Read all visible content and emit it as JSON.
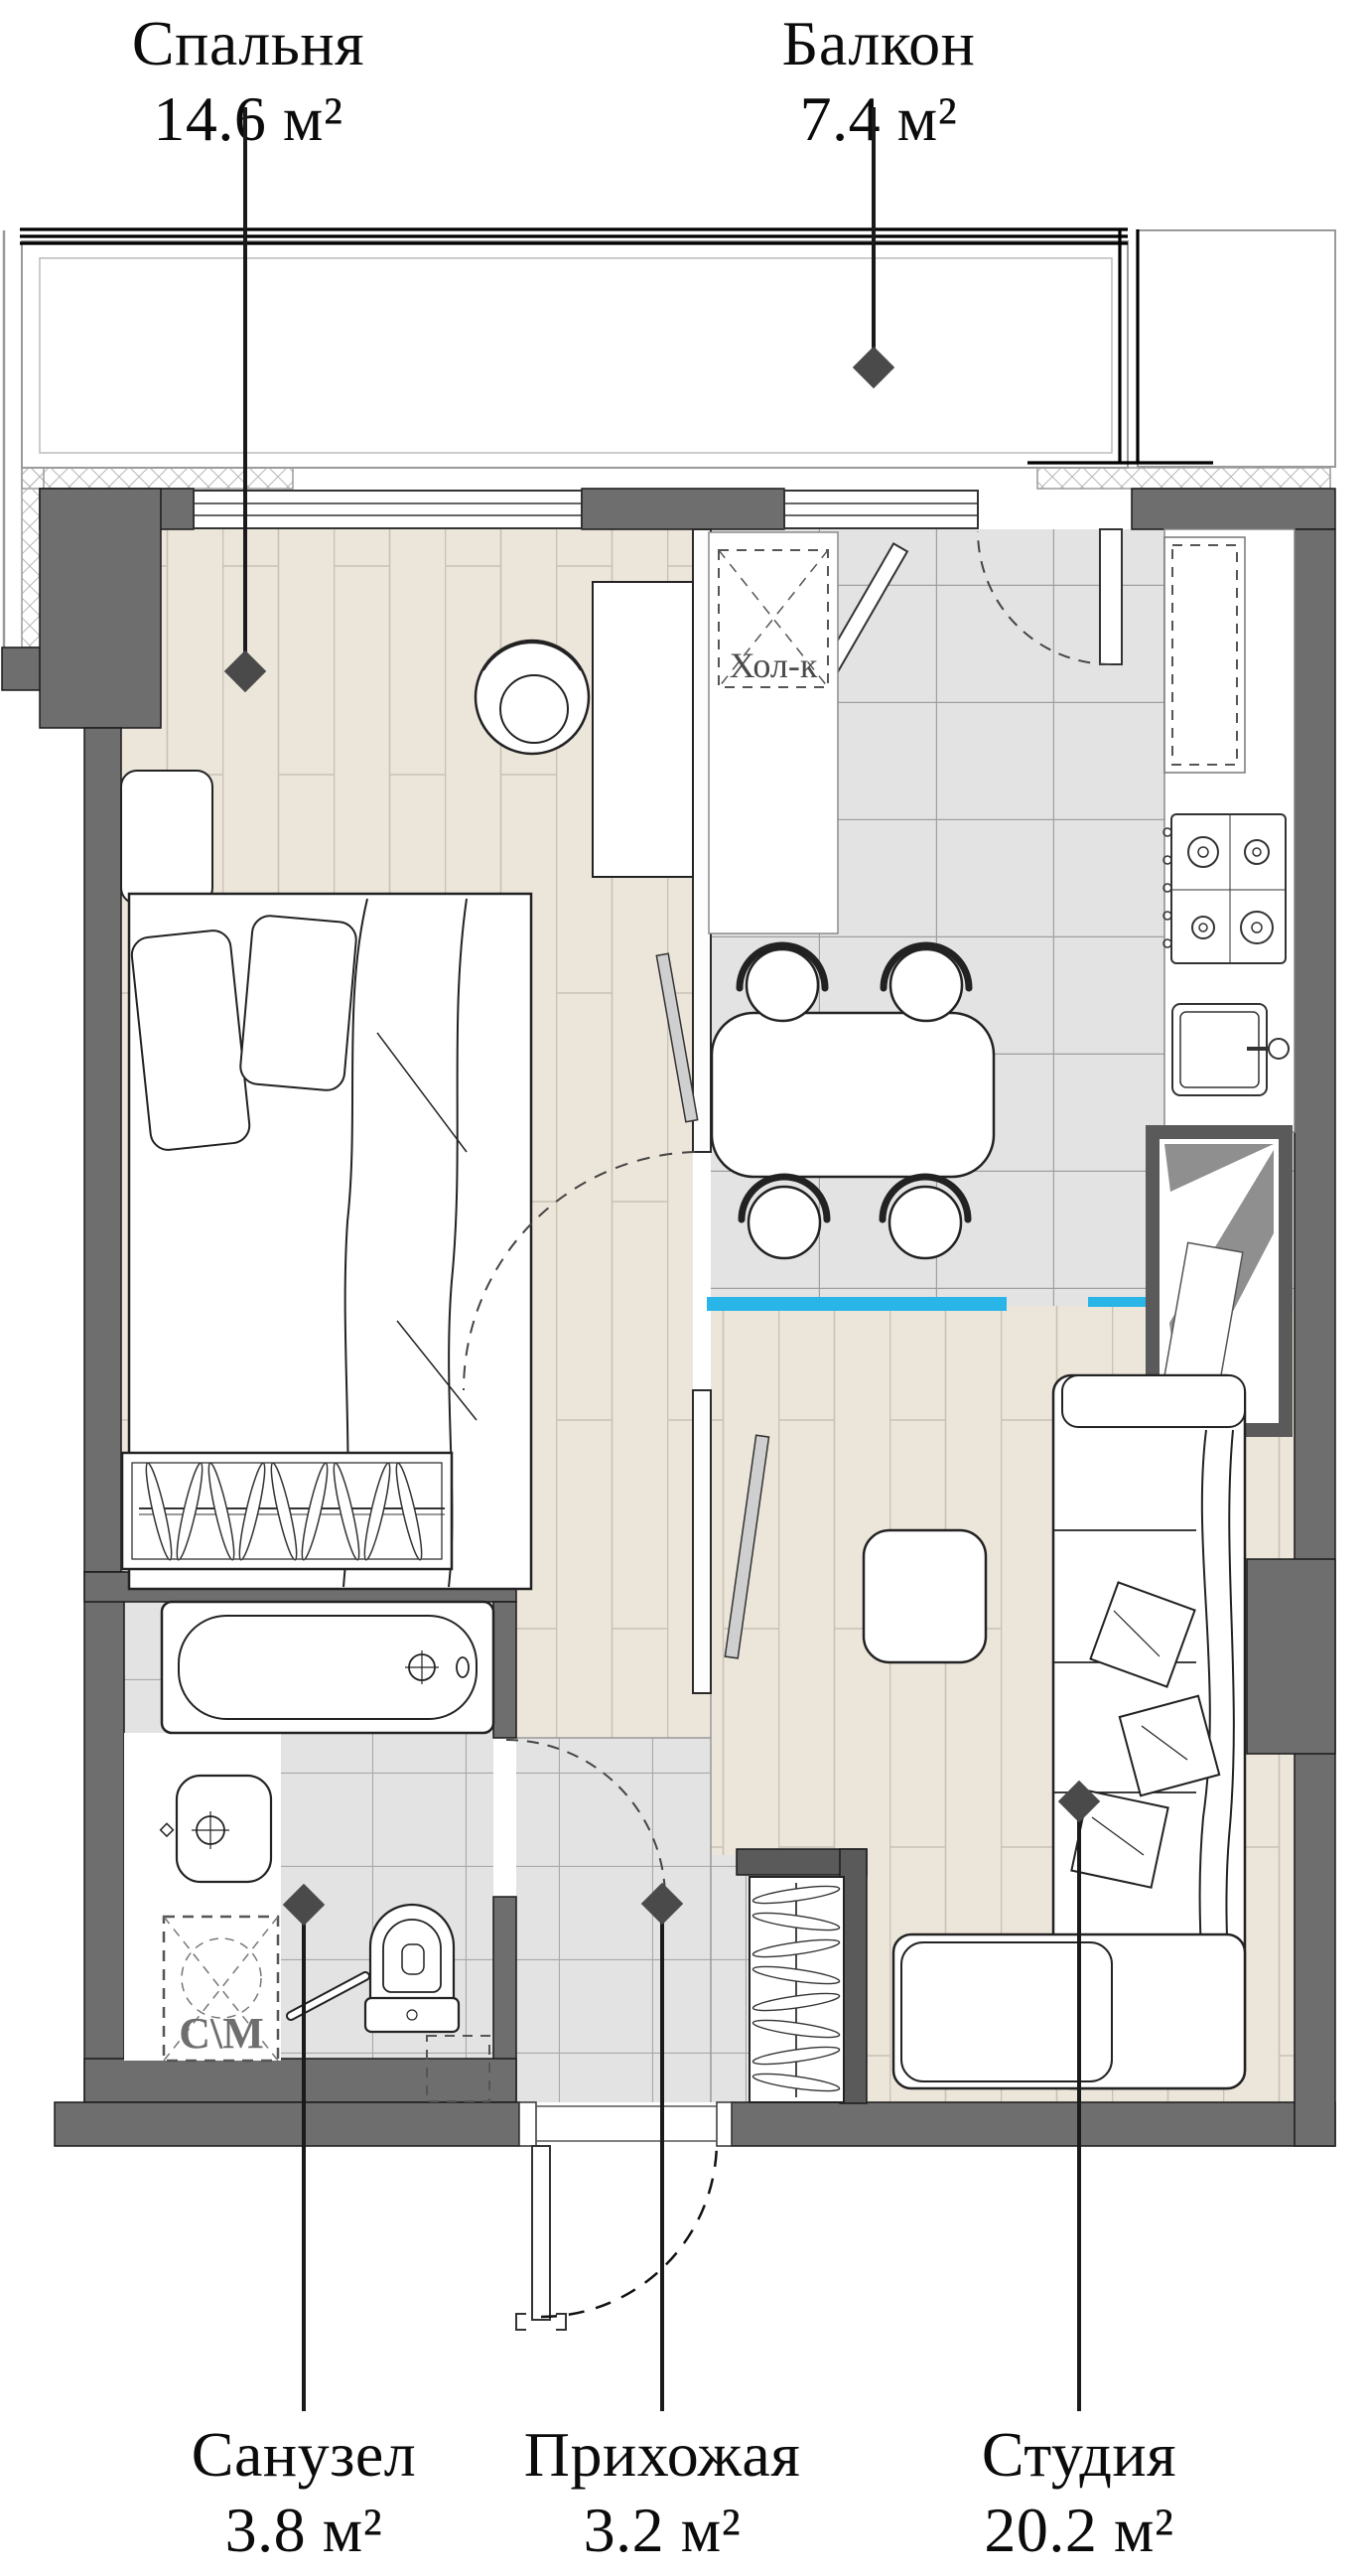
{
  "plan": {
    "title": "Apartment floor plan",
    "rooms": {
      "bedroom": {
        "name": "Спальня",
        "area": "14.6 м²"
      },
      "balcony": {
        "name": "Балкон",
        "area": "7.4 м²"
      },
      "bathroom": {
        "name": "Санузел",
        "area": "3.8 м²"
      },
      "hallway": {
        "name": "Прихожая",
        "area": "3.2 м²"
      },
      "studio": {
        "name": "Студия",
        "area": "20.2 м²"
      }
    },
    "annotations": {
      "fridge": "Хол-к",
      "washing_machine": "С\\М"
    },
    "colors": {
      "wall": "#6e6e6e",
      "wall_dark": "#5a5a5a",
      "wood_floor": "#ece5da",
      "tile_floor": "#e3e3e3",
      "accent_blue": "#2ab5e8",
      "marker": "#4a4a4a",
      "line": "#1a1a1a"
    }
  }
}
